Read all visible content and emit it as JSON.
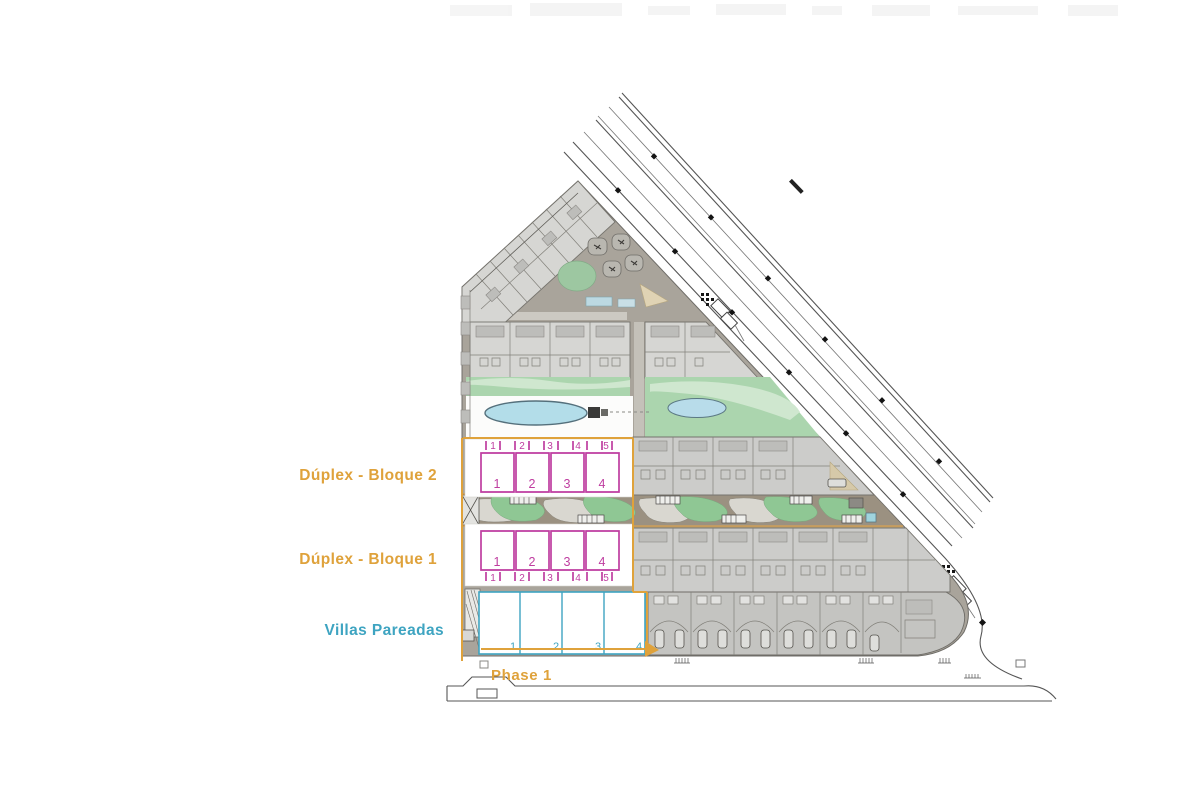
{
  "labels": {
    "duplex_bloque_2": "Dúplex - Bloque 2",
    "duplex_bloque_1": "Dúplex - Bloque 1",
    "villas_pareadas": "Villas Pareadas",
    "phase_1": "Phase 1"
  },
  "units": {
    "bloque2_upper": [
      "1",
      "2",
      "3",
      "4",
      "5"
    ],
    "bloque2_main": [
      "1",
      "2",
      "3",
      "4"
    ],
    "bloque1_main": [
      "1",
      "2",
      "3",
      "4"
    ],
    "bloque1_lower": [
      "1",
      "2",
      "3",
      "4",
      "5"
    ],
    "villas": [
      "1",
      "2",
      "3",
      "4"
    ]
  },
  "colors": {
    "phase_orange": "#DFA23B",
    "duplex_magenta": "#BF3DA0",
    "villas_teal": "#3EA4C1",
    "pool_blue": "#B3DDE9",
    "landscape_green": "#8FC794",
    "ground_grey": "#A9A49B",
    "building_grey": "#D4D4D1",
    "road_grey": "#555555"
  }
}
